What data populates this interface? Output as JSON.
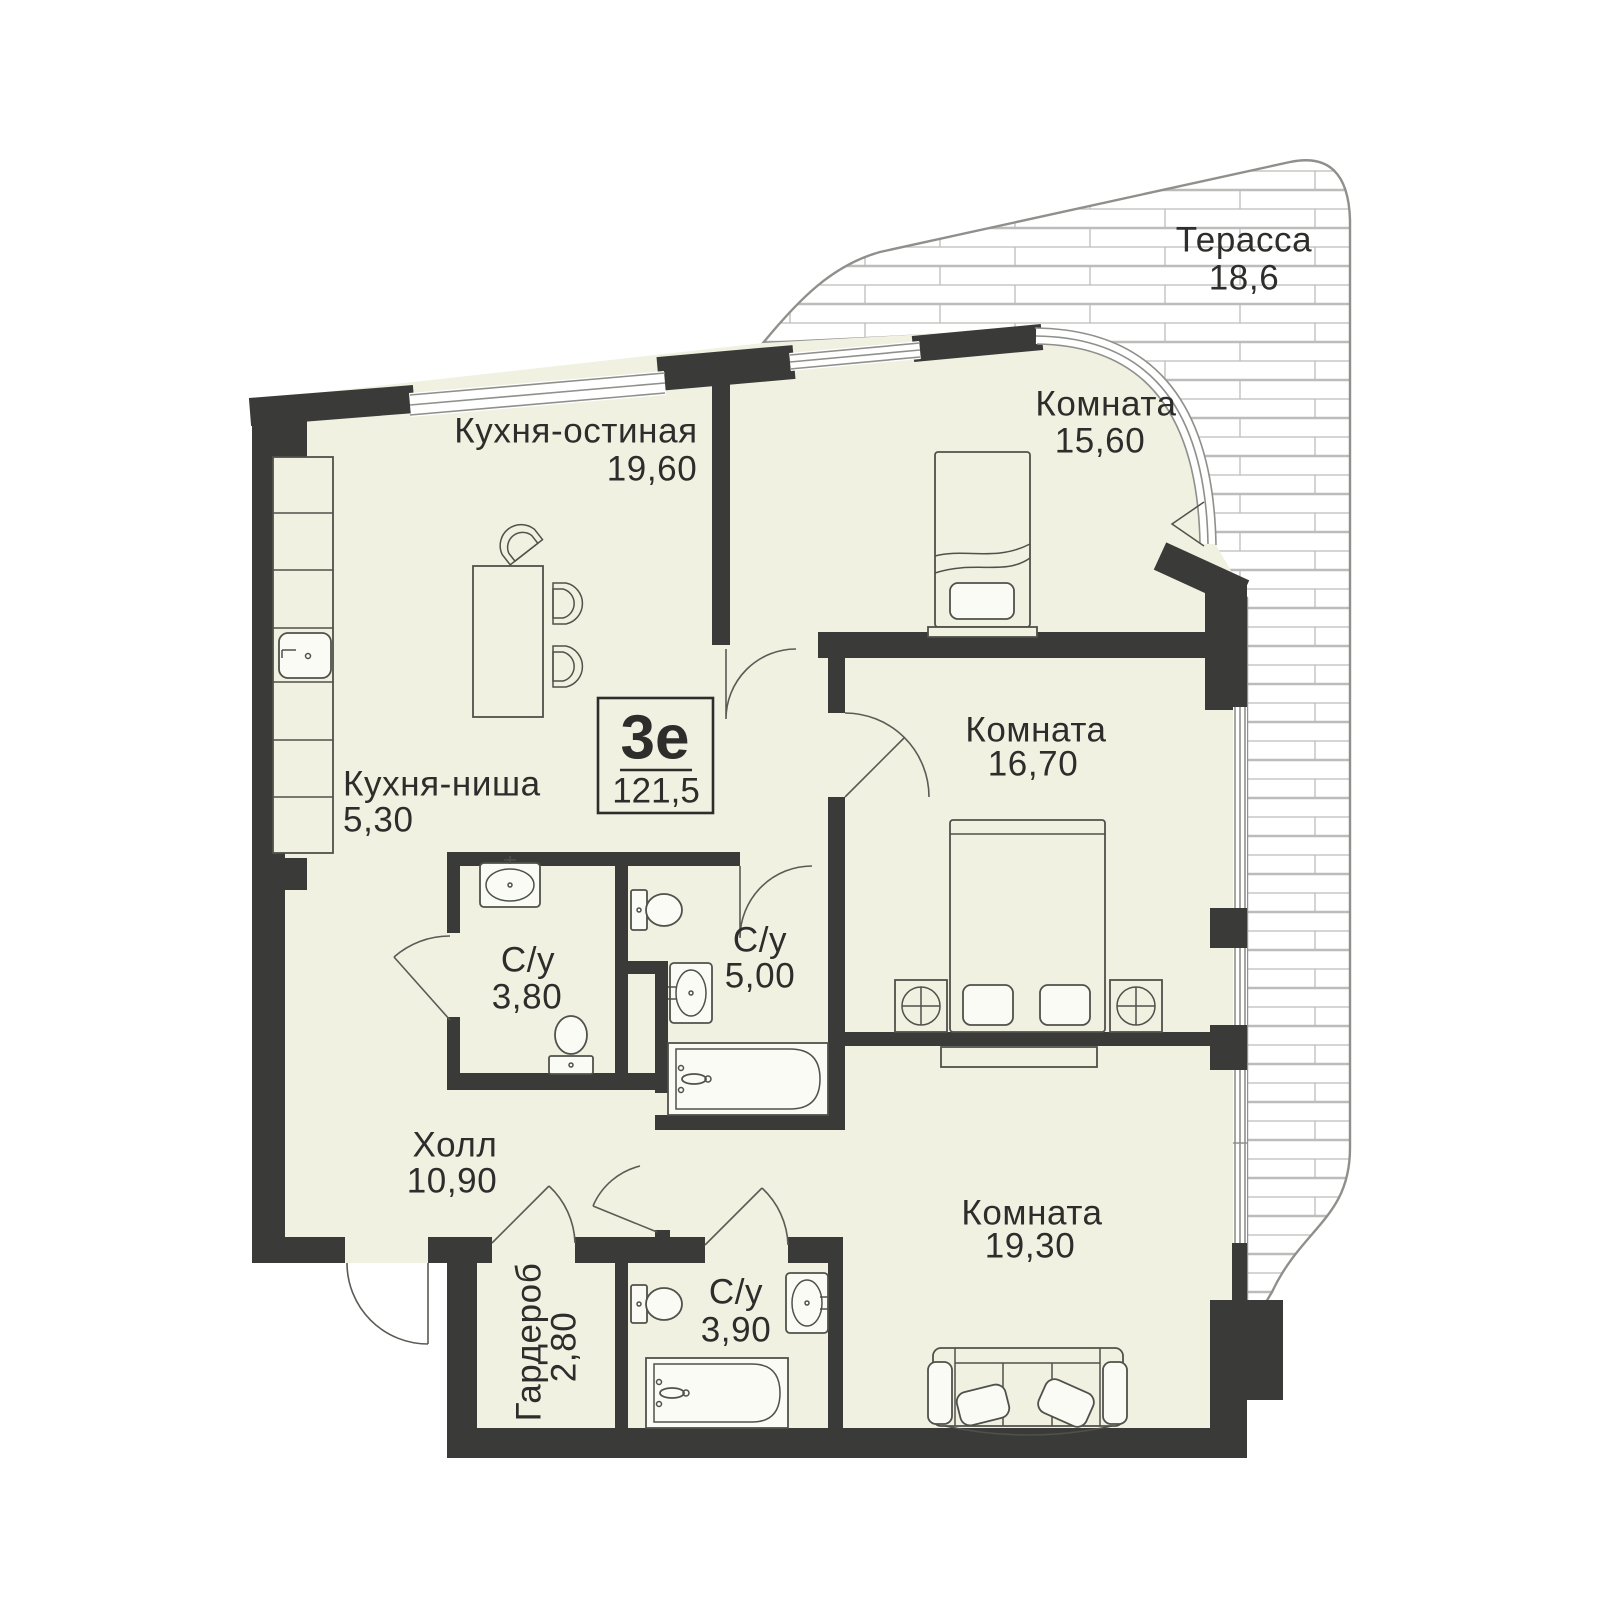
{
  "plan": {
    "unit": {
      "type": "3е",
      "area": "121,5"
    },
    "rooms": [
      {
        "id": "kitchen-living",
        "name": "Кухня-остиная",
        "area": "19,60"
      },
      {
        "id": "bedroom-1",
        "name": "Комната",
        "area": "15,60"
      },
      {
        "id": "terrace",
        "name": "Терасса",
        "area": "18,6"
      },
      {
        "id": "bedroom-2",
        "name": "Комната",
        "area": "16,70"
      },
      {
        "id": "kitchen-niche",
        "name": "Кухня-ниша",
        "area": "5,30"
      },
      {
        "id": "bathroom-1",
        "name": "С/у",
        "area": "3,80"
      },
      {
        "id": "bathroom-2",
        "name": "С/у",
        "area": "5,00"
      },
      {
        "id": "hall",
        "name": "Холл",
        "area": "10,90"
      },
      {
        "id": "wardrobe",
        "name": "Гардероб",
        "area": "2,80"
      },
      {
        "id": "bathroom-3",
        "name": "С/у",
        "area": "3,90"
      },
      {
        "id": "bedroom-3",
        "name": "Комната",
        "area": "19,30"
      }
    ],
    "colors": {
      "wall": "#3a3a38",
      "floor": "#f0f1e1",
      "terrace_line": "#b5b5b3",
      "text": "#2d2d2b"
    }
  }
}
